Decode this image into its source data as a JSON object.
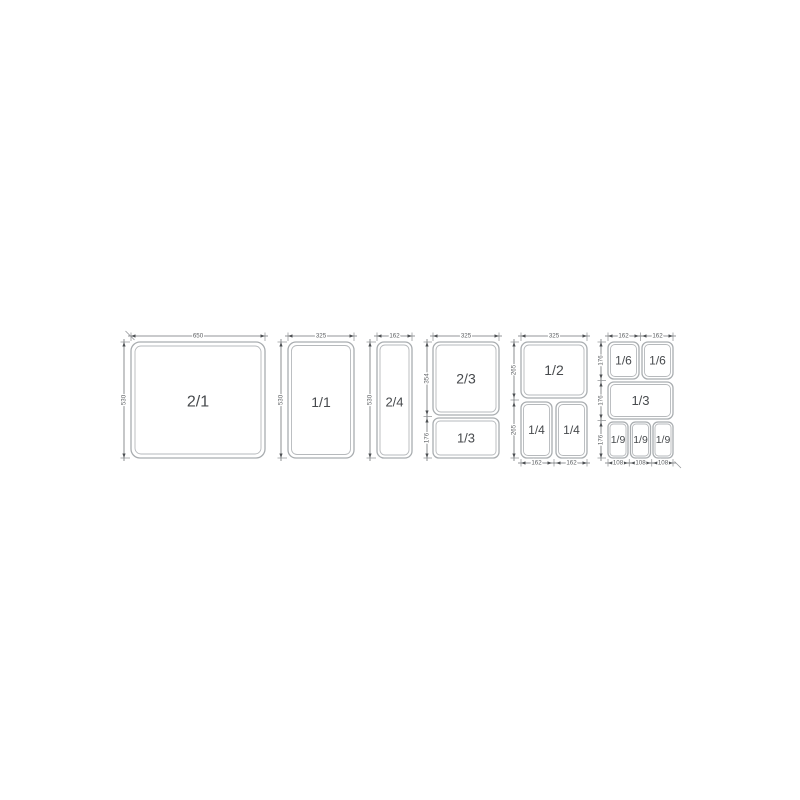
{
  "diagram_type": "gastronorm-pan-size-dimension-diagram",
  "units": "mm",
  "colors": {
    "background": "#ffffff",
    "pan_outline": "#a9adb0",
    "dimension_line": "#6f7376",
    "arrow": "#4d5053",
    "pan_label_text": "#474a4d",
    "dimension_text": "#5d6063"
  },
  "panels": [
    {
      "cells": [
        {
          "label": "2/1"
        }
      ],
      "dims": {
        "top": [
          "650"
        ],
        "left": [
          "530"
        ]
      }
    },
    {
      "cells": [
        {
          "label": "1/1"
        }
      ],
      "dims": {
        "top": [
          "325"
        ],
        "left": [
          "530"
        ]
      }
    },
    {
      "cells": [
        {
          "label": "2/4"
        }
      ],
      "dims": {
        "top": [
          "162"
        ],
        "left": [
          "530"
        ]
      }
    },
    {
      "cells": [
        {
          "label": "2/3"
        },
        {
          "label": "1/3"
        }
      ],
      "dims": {
        "top": [
          "325"
        ],
        "left": [
          "354",
          "176"
        ]
      }
    },
    {
      "cells": [
        {
          "label": "1/2"
        },
        {
          "label": "1/4"
        },
        {
          "label": "1/4"
        }
      ],
      "dims": {
        "top": [
          "325"
        ],
        "left": [
          "265",
          "265"
        ],
        "bottom": [
          "162",
          "162"
        ]
      }
    },
    {
      "cells": [
        {
          "label": "1/6"
        },
        {
          "label": "1/6"
        },
        {
          "label": "1/3"
        },
        {
          "label": "1/9"
        },
        {
          "label": "1/9"
        },
        {
          "label": "1/9"
        }
      ],
      "dims": {
        "top": [
          "162",
          "162"
        ],
        "left": [
          "176",
          "176",
          "176"
        ],
        "bottom": [
          "108",
          "108",
          "108"
        ]
      }
    }
  ]
}
